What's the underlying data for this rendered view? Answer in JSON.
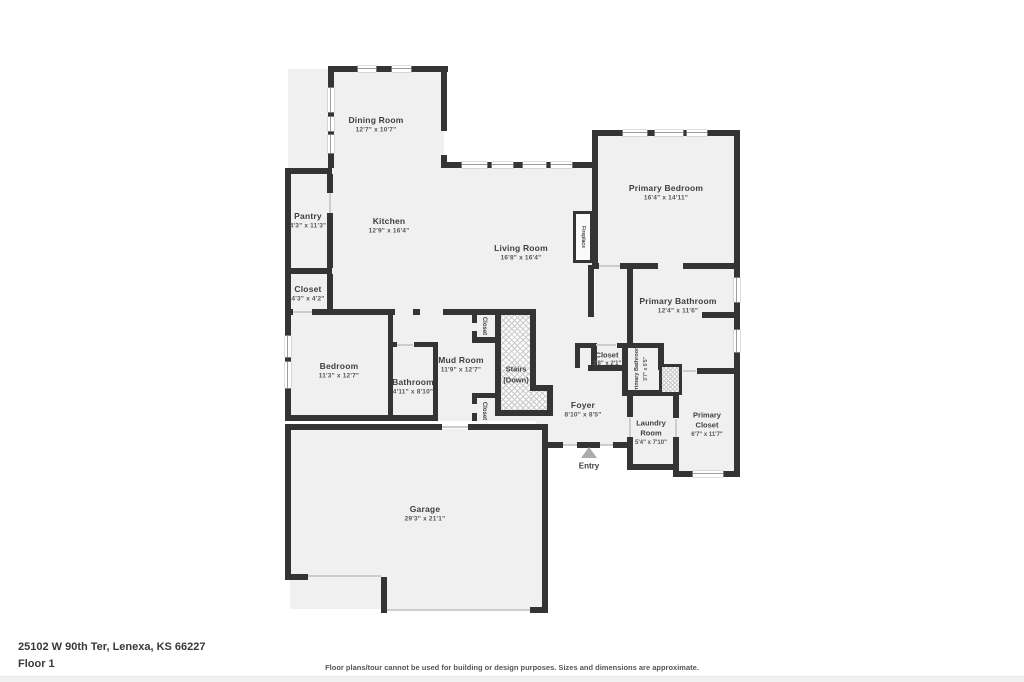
{
  "page": {
    "address": "25102 W 90th Ter, Lenexa, KS 66227",
    "floor_label": "Floor 1",
    "disclaimer": "Floor plans/tour cannot be used for building or design purposes. Sizes and dimensions are approximate.",
    "entry_label": "Entry"
  },
  "colors": {
    "wall": "#343434",
    "room_fill": "#f0f0f1",
    "page_bg": "#ffffff",
    "footer_strip": "#f1f1f2"
  },
  "rooms": {
    "dining": {
      "name": "Dining Room",
      "dims": "12'7\" x 10'7\""
    },
    "kitchen": {
      "name": "Kitchen",
      "dims": "12'9\" x 16'4\""
    },
    "pantry": {
      "name": "Pantry",
      "dims": "4'3\" x 11'3\""
    },
    "closet_kitchen": {
      "name": "Closet",
      "dims": "4'3\" x 4'2\""
    },
    "living": {
      "name": "Living Room",
      "dims": "16'8\" x 16'4\""
    },
    "primary_bedroom": {
      "name": "Primary Bedroom",
      "dims": "16'4\" x 14'11\""
    },
    "primary_bathroom": {
      "name": "Primary Bathroom",
      "dims": "12'4\" x 11'6\""
    },
    "hall_closet": {
      "name": "Closet",
      "dims": "3'8\" x 2'1\""
    },
    "primary_bathroom_small": {
      "name": "Primary Bathroom",
      "dims": "3'7\" x 5'5\""
    },
    "primary_closet": {
      "line1": "Primary",
      "line2": "Closet",
      "dims": "6'7\" x 11'7\""
    },
    "laundry": {
      "line1": "Laundry",
      "line2": "Room",
      "dims": "5'4\" x 7'10\""
    },
    "foyer": {
      "name": "Foyer",
      "dims": "8'10\" x 8'5\""
    },
    "mud_room": {
      "name": "Mud Room",
      "dims": "11'9\" x 12'7\""
    },
    "bedroom": {
      "name": "Bedroom",
      "dims": "11'3\" x 12'7\""
    },
    "bathroom": {
      "name": "Bathroom",
      "dims": "4'11\" x 8'10\""
    },
    "garage": {
      "name": "Garage",
      "dims": "29'3\" x 21'1\""
    },
    "stairs": {
      "line1": "Stairs",
      "line2": "(Down)"
    },
    "closet_mud_top": {
      "name": "Closet"
    },
    "closet_mud_bottom": {
      "name": "Closet"
    },
    "fireplace": {
      "name": "Fireplace"
    }
  }
}
